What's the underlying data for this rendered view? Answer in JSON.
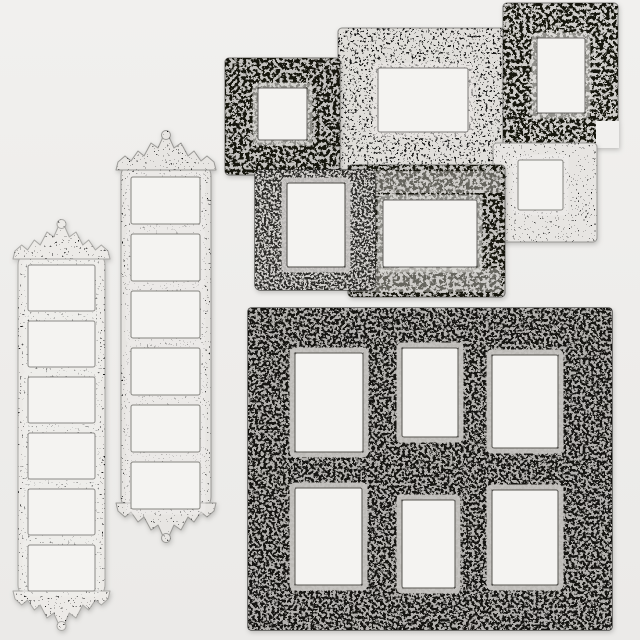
{
  "canvas": {
    "width": 640,
    "height": 640
  },
  "palette": {
    "background_top": "#f1f0ee",
    "background_bottom": "#ebeae8",
    "paper": "#f4f3f1"
  },
  "textures": [
    {
      "id": "sparse",
      "flood": "#1c1c1a",
      "base_frequency": 0.5,
      "octaves": 2,
      "seed": 3,
      "table": "0 0 0 0 1 1"
    },
    {
      "id": "sparse2",
      "flood": "#191917",
      "base_frequency": 0.55,
      "octaves": 2,
      "seed": 8,
      "table": "0 0 0 0 1 1"
    },
    {
      "id": "med",
      "flood": "#161614",
      "base_frequency": 0.42,
      "octaves": 3,
      "seed": 5,
      "table": "0 0 0 1 1"
    },
    {
      "id": "heavy",
      "flood": "#121210",
      "base_frequency": 0.3,
      "octaves": 4,
      "seed": 11,
      "table": "0 0 1 1"
    },
    {
      "id": "lightmed",
      "flood": "#b3b1ae",
      "base_frequency": 0.36,
      "octaves": 3,
      "seed": 17,
      "table": "0 0 1 1"
    },
    {
      "id": "lighthvy",
      "flood": "#cfcdca",
      "base_frequency": 0.45,
      "octaves": 3,
      "seed": 23,
      "table": "0 0 1 1"
    }
  ],
  "styles": {
    "white": {
      "base": "#eceae7",
      "stroke": "#a9a8a5",
      "tex": "sparse",
      "ring": "#f0efed",
      "ring_opacity": 0.5,
      "open_stroke": "#8a8986"
    },
    "silver_light": {
      "base": "#e7e5e2",
      "stroke": "#9a9996",
      "tex": "sparse2",
      "ring": "#efeeec",
      "ring_opacity": 0.5,
      "open_stroke": "#85847f"
    },
    "silver": {
      "base": "#e0deda",
      "stroke": "#8b8a87",
      "tex": "med",
      "ring": "#eceae7",
      "ring_opacity": 0.55,
      "open_stroke": "#7b7a77"
    },
    "antique": {
      "base": "#c4c2bf",
      "stroke": "#6a6966",
      "tex": "heavy",
      "ring": "#dedcd9",
      "ring_opacity": 0.6,
      "open_stroke": "#63625f"
    },
    "antique_light": {
      "base": "#cfcdca",
      "stroke": "#7a7976",
      "tex": "heavy",
      "ring": "#e4e2df",
      "ring_opacity": 0.6,
      "open_stroke": "#6b6a67"
    },
    "dark": {
      "base": "#2e2d2a",
      "stroke": "#1e1e1c",
      "tex": "lighthvy",
      "ring": "#cbc9c6",
      "ring_opacity": 0.9,
      "open_stroke": "#4a4844"
    },
    "black": {
      "base": "#161512",
      "stroke": "#0d0d0b",
      "tex": "lightmed",
      "ring": "#c6c4c1",
      "ring_opacity": 0.95,
      "open_stroke": "#565450"
    }
  },
  "frames": [
    {
      "id": "tall-left",
      "style": "white",
      "x": 18,
      "y": 252,
      "w": 87,
      "h": 346,
      "rx": 13,
      "crest": true,
      "openings": [
        {
          "x": 28,
          "y": 265,
          "w": 67,
          "h": 46
        },
        {
          "x": 28,
          "y": 321,
          "w": 67,
          "h": 46
        },
        {
          "x": 28,
          "y": 377,
          "w": 67,
          "h": 46
        },
        {
          "x": 28,
          "y": 433,
          "w": 67,
          "h": 46
        },
        {
          "x": 28,
          "y": 489,
          "w": 67,
          "h": 46
        },
        {
          "x": 28,
          "y": 545,
          "w": 67,
          "h": 46
        }
      ]
    },
    {
      "id": "tall-middle",
      "style": "silver_light",
      "x": 121,
      "y": 163,
      "w": 90,
      "h": 347,
      "rx": 13,
      "crest": true,
      "openings": [
        {
          "x": 131,
          "y": 177,
          "w": 69,
          "h": 47
        },
        {
          "x": 131,
          "y": 234,
          "w": 69,
          "h": 47
        },
        {
          "x": 131,
          "y": 291,
          "w": 69,
          "h": 47
        },
        {
          "x": 131,
          "y": 348,
          "w": 69,
          "h": 47
        },
        {
          "x": 131,
          "y": 405,
          "w": 69,
          "h": 47
        },
        {
          "x": 131,
          "y": 462,
          "w": 69,
          "h": 47
        }
      ]
    },
    {
      "id": "cluster-silver-large",
      "style": "silver",
      "x": 338,
      "y": 28,
      "w": 167,
      "h": 147,
      "rx": 4,
      "openings": [
        {
          "x": 378,
          "y": 68,
          "w": 90,
          "h": 64
        }
      ]
    },
    {
      "id": "cluster-square-top-left",
      "style": "antique",
      "x": 225,
      "y": 58,
      "w": 115,
      "h": 117,
      "rx": 4,
      "openings": [
        {
          "x": 258,
          "y": 88,
          "w": 49,
          "h": 52
        }
      ]
    },
    {
      "id": "cluster-top-right",
      "style": "antique_light",
      "x": 503,
      "y": 3,
      "w": 115,
      "h": 144,
      "rx": 4,
      "cutouts": [
        {
          "x": 596,
          "y": 121,
          "w": 23,
          "h": 27
        }
      ],
      "openings": [
        {
          "x": 537,
          "y": 38,
          "w": 48,
          "h": 75
        }
      ]
    },
    {
      "id": "cluster-mid-right",
      "style": "silver_light",
      "x": 493,
      "y": 143,
      "w": 104,
      "h": 99,
      "rx": 4,
      "openings": [
        {
          "x": 518,
          "y": 160,
          "w": 45,
          "h": 50
        }
      ]
    },
    {
      "id": "cluster-wide-bottom",
      "style": "antique",
      "x": 348,
      "y": 165,
      "w": 157,
      "h": 132,
      "rx": 4,
      "bands": [
        {
          "x": 352,
          "y": 171,
          "w": 149,
          "h": 22
        },
        {
          "x": 352,
          "y": 268,
          "w": 149,
          "h": 24
        }
      ],
      "openings": [
        {
          "x": 383,
          "y": 200,
          "w": 94,
          "h": 67
        }
      ]
    },
    {
      "id": "cluster-dark-portrait",
      "style": "dark",
      "x": 255,
      "y": 170,
      "w": 120,
      "h": 120,
      "rx": 5,
      "openings": [
        {
          "x": 287,
          "y": 183,
          "w": 58,
          "h": 84
        }
      ]
    },
    {
      "id": "collage-six-black",
      "style": "black",
      "x": 248,
      "y": 308,
      "w": 364,
      "h": 322,
      "rx": 3,
      "openings": [
        {
          "x": 295,
          "y": 353,
          "w": 68,
          "h": 99
        },
        {
          "x": 402,
          "y": 348,
          "w": 56,
          "h": 89
        },
        {
          "x": 492,
          "y": 355,
          "w": 66,
          "h": 93
        },
        {
          "x": 295,
          "y": 488,
          "w": 67,
          "h": 97
        },
        {
          "x": 402,
          "y": 500,
          "w": 53,
          "h": 88
        },
        {
          "x": 492,
          "y": 490,
          "w": 66,
          "h": 95
        }
      ]
    }
  ]
}
